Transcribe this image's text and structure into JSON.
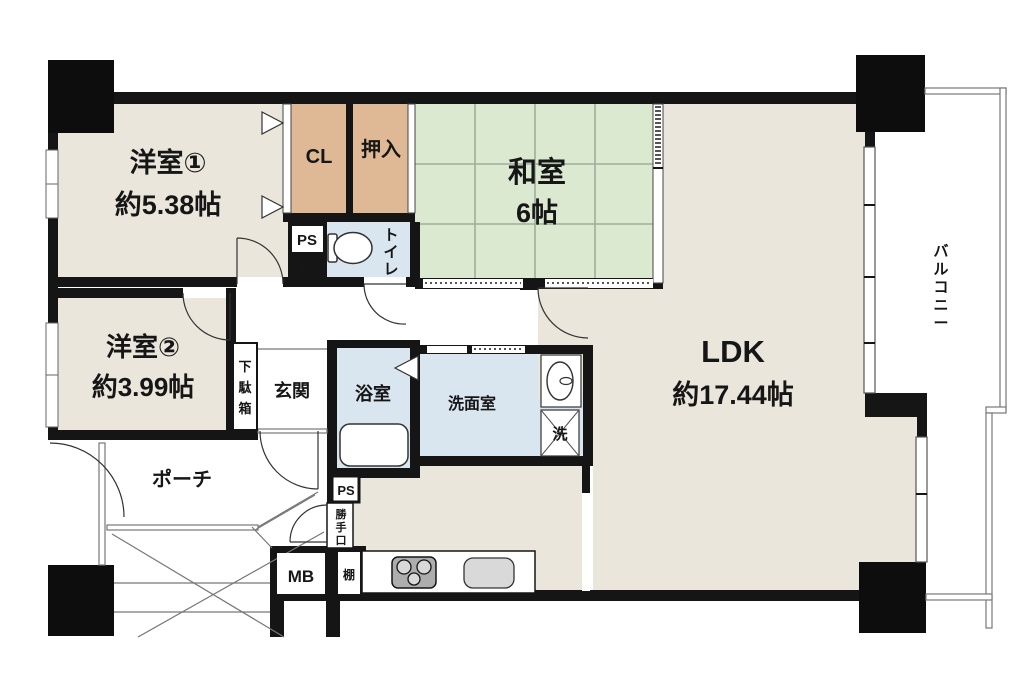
{
  "plan": {
    "title": "apartment-floor-plan",
    "colors": {
      "wall": "#151515",
      "room_beige": "#eae6db",
      "tatami_green": "#dbe9d0",
      "tatami_line": "#9fae9b",
      "closet_tan": "#dfb996",
      "wet_blue": "#d9e6f0",
      "thin_line": "#777777",
      "fixture_gray": "#adadad",
      "sink_gray": "#d9d9d9"
    },
    "rooms": {
      "yoshitsu1": {
        "name": "洋室①",
        "size": "約5.38帖"
      },
      "yoshitsu2": {
        "name": "洋室②",
        "size": "約3.99帖"
      },
      "washitsu": {
        "name": "和室",
        "size": "6帖"
      },
      "ldk": {
        "name": "LDK",
        "size": "約17.44帖"
      },
      "cl": {
        "name": "CL"
      },
      "oshiire": {
        "name": "押入"
      },
      "ps_upper": {
        "name": "PS"
      },
      "tana_upper": {
        "name": "棚"
      },
      "toilet": {
        "chars": [
          "ト",
          "イ",
          "レ"
        ]
      },
      "getabako": {
        "chars": [
          "下",
          "駄",
          "箱"
        ]
      },
      "genkan": {
        "name": "玄関"
      },
      "yokushitsu": {
        "name": "浴室"
      },
      "senmen": {
        "name": "洗面室"
      },
      "laundry": {
        "name": "洗"
      },
      "porch": {
        "name": "ポーチ"
      },
      "ps_lower": {
        "name": "PS"
      },
      "katteguchi": {
        "chars": [
          "勝",
          "手",
          "口"
        ]
      },
      "mb": {
        "name": "MB"
      },
      "tana_lower": {
        "name": "棚"
      },
      "balcony": {
        "chars": [
          "バ",
          "ル",
          "コ",
          "ニ",
          "ー"
        ]
      }
    }
  }
}
